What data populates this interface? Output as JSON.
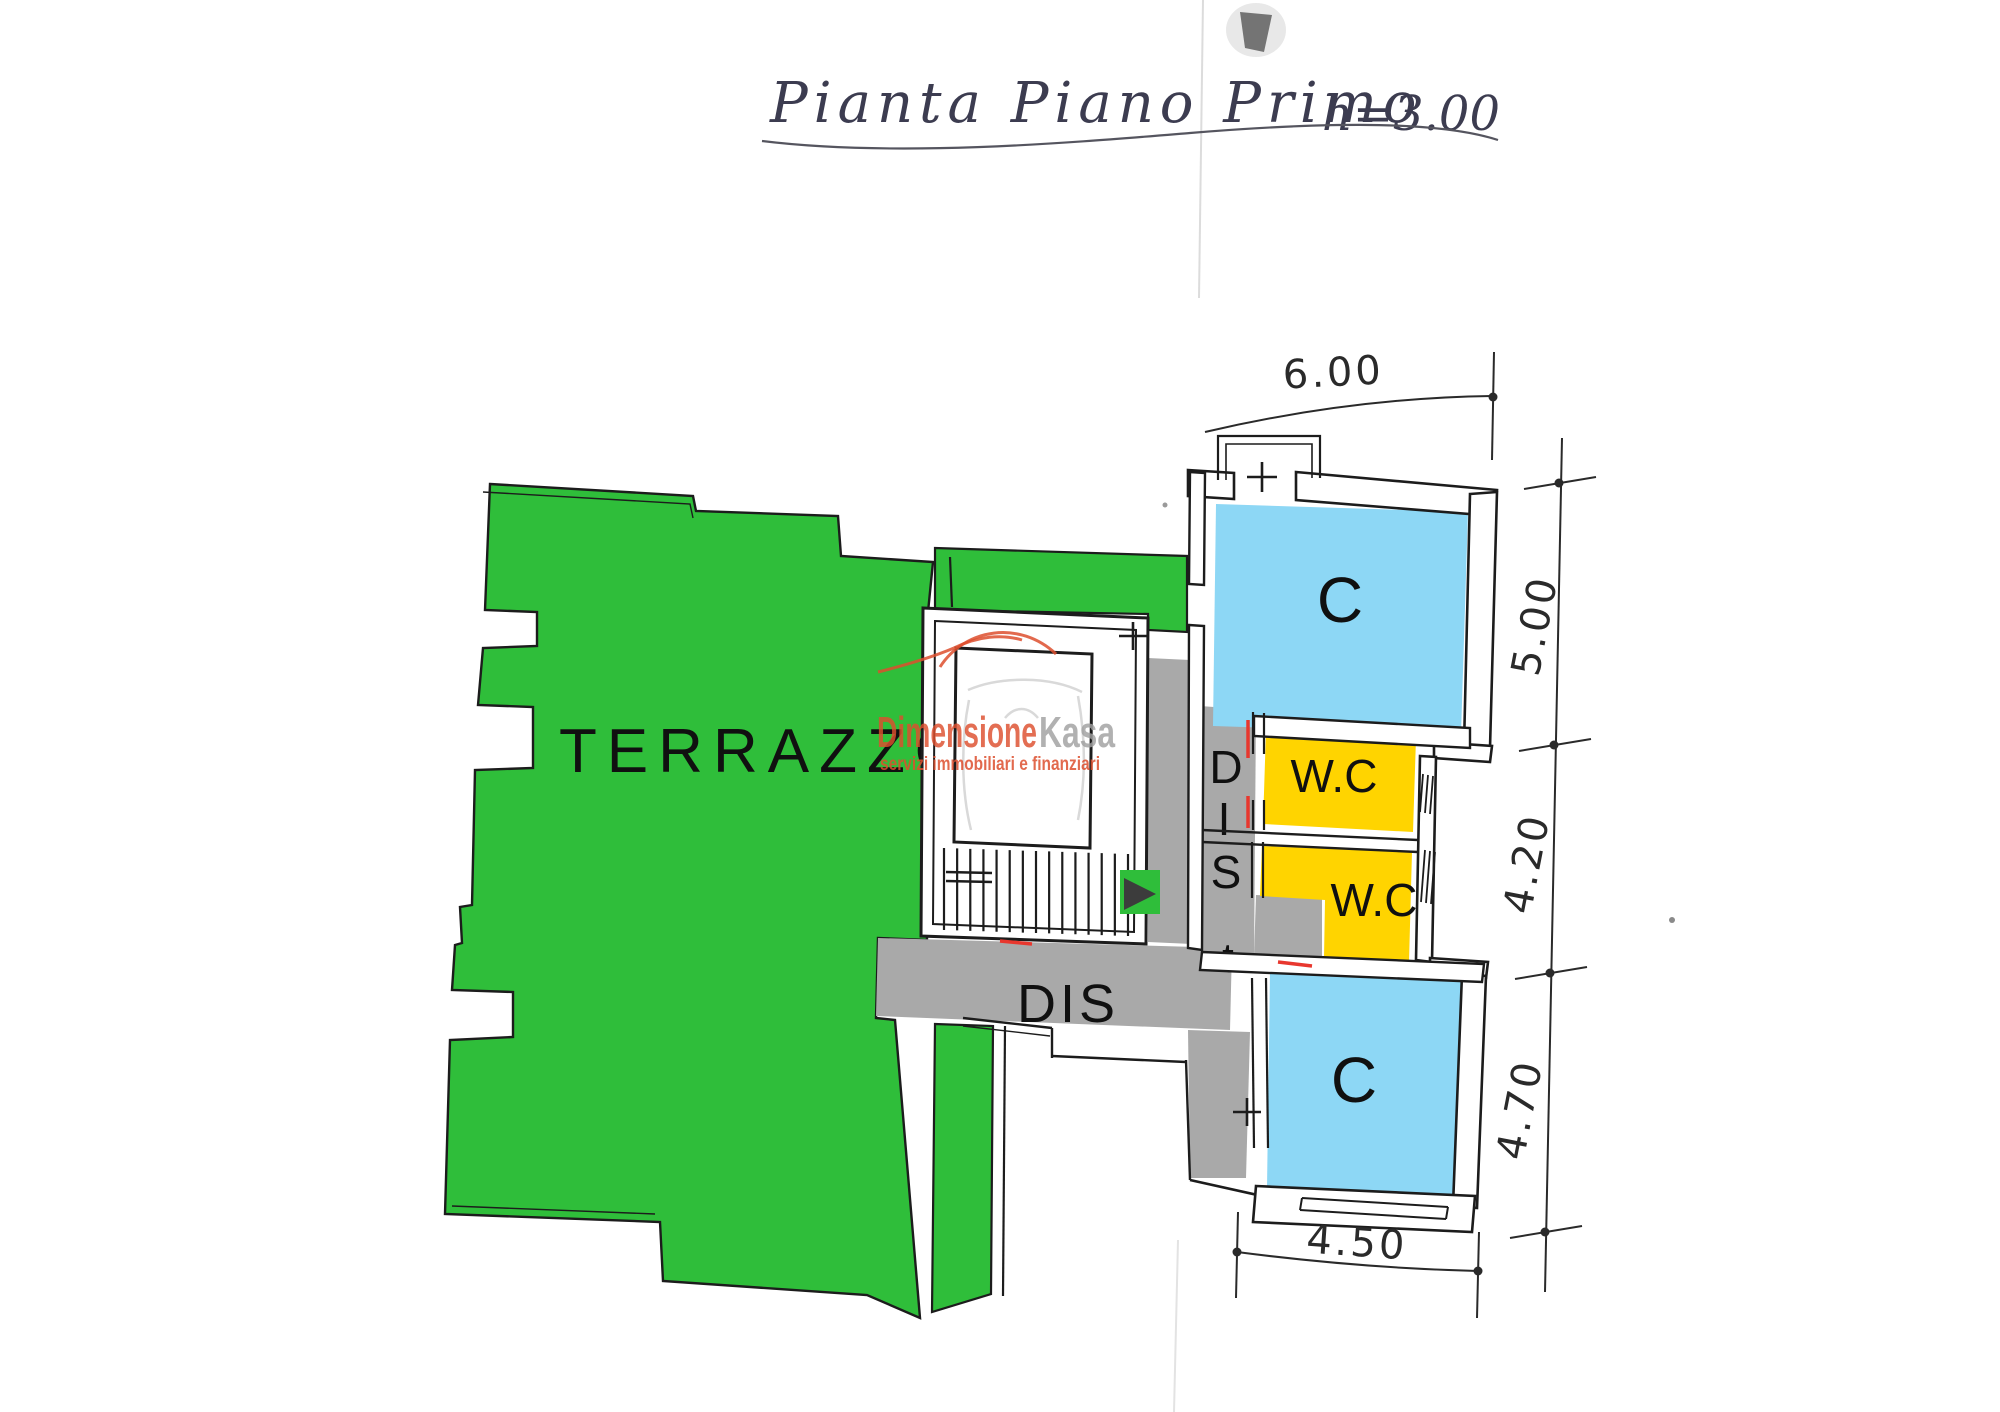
{
  "title": {
    "main": "Pianta Piano Primo",
    "height_note": "h=3.00"
  },
  "rooms": {
    "terrazzo": "TERRAZZO",
    "camera_top": "C",
    "camera_bottom": "C",
    "wc_top": "W.C",
    "wc_bottom": "W.C",
    "dis_main": "DIS",
    "dis_vertical_letters": [
      "D",
      "I",
      "S",
      "t"
    ]
  },
  "dimensions": {
    "top_width": "6.00",
    "right_top": "5.00",
    "right_middle": "4.20",
    "right_bottom": "4.70",
    "bottom_width": "4.50"
  },
  "watermark": {
    "brand_primary": "Dimensione",
    "brand_secondary": "Kasa",
    "tagline": "servizi immobiliari e finanziari"
  },
  "colors": {
    "terrace_green": "#2fbe3a",
    "room_blue": "#8dd7f5",
    "room_yellow": "#ffd400",
    "corridor_gray": "#a9a9a9",
    "wall_ink": "#1c1c1c",
    "title_ink": "#3c3c50",
    "brand_red": "#dd4f2e",
    "brand_gray": "#a0a0a0",
    "mark_red": "#e8372e",
    "stair_arrow": "#3c3c3c"
  }
}
